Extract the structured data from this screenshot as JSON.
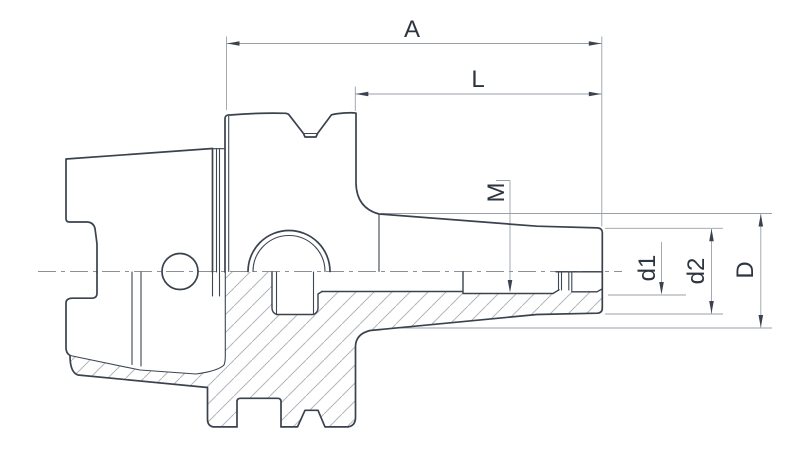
{
  "drawing": {
    "labels": {
      "a": "A",
      "l": "L",
      "m": "M",
      "d1": "d1",
      "d2": "d2",
      "d_big": "D"
    },
    "colors": {
      "outline": "#3a424e",
      "dimension_lines": "#9aa0a8",
      "text": "#2d3640",
      "hatch": "#b2b7bd",
      "centerline": "#8a9099",
      "background": "#ffffff"
    }
  }
}
